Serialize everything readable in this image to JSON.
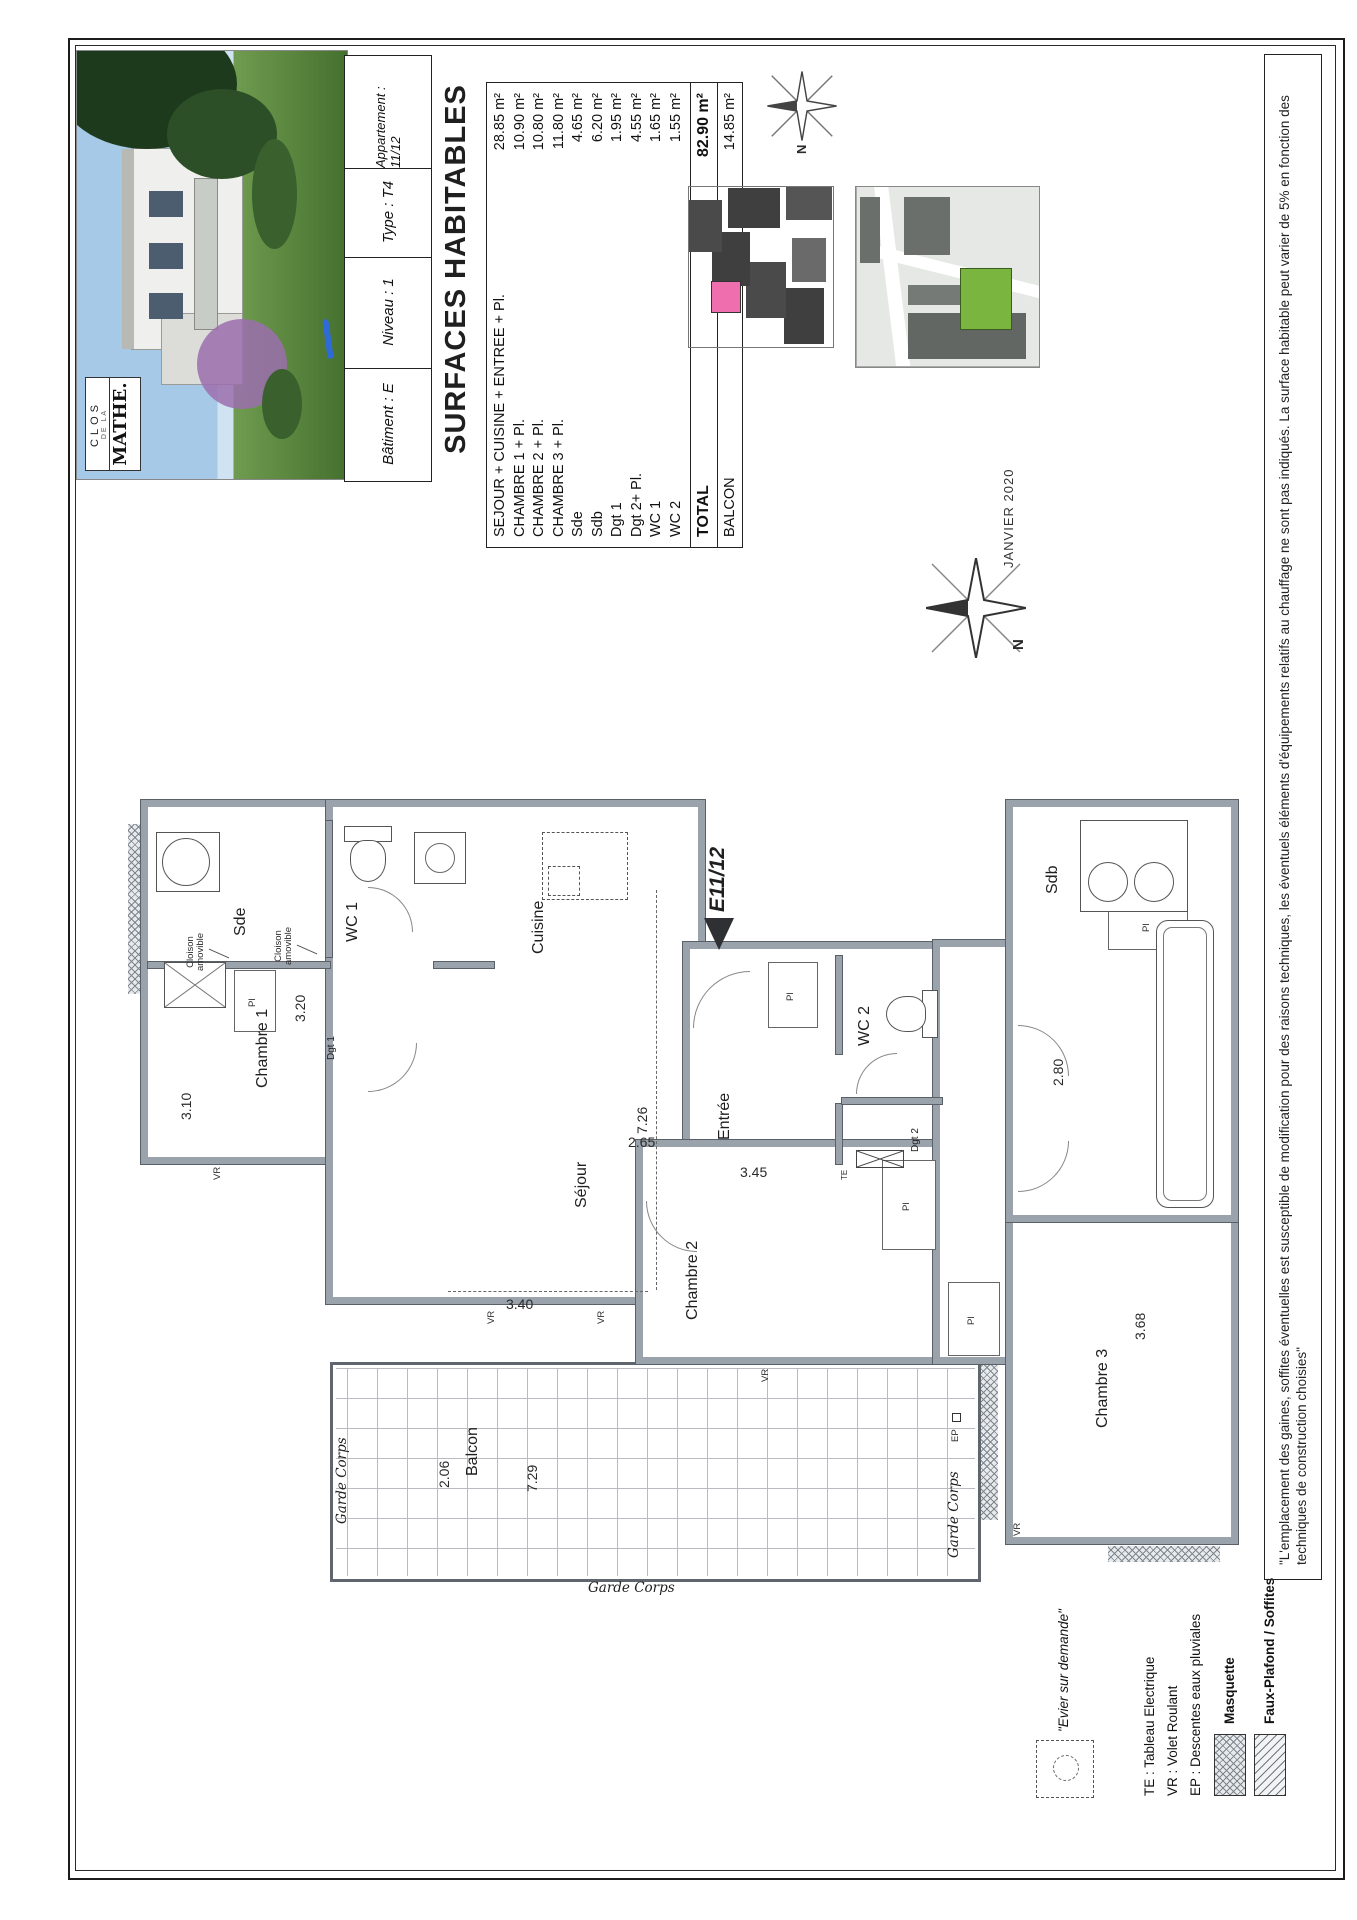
{
  "page": {
    "date": "JANVIER 2020",
    "watermark": "immobilier"
  },
  "logo": {
    "line1": "CLOS",
    "line2": "DE LA",
    "line3": "MATHE."
  },
  "title_block": {
    "batiment": "Bâtiment : E",
    "niveau": "Niveau : 1",
    "type": "Type : T4",
    "appartement": "Appartement : 11/12"
  },
  "surfaces": {
    "title": "SURFACES HABITABLES",
    "rows": [
      {
        "label": "SEJOUR + CUISINE + ENTREE + Pl.",
        "value": "28.85 m²"
      },
      {
        "label": "CHAMBRE 1 + Pl.",
        "value": "10.90 m²"
      },
      {
        "label": "CHAMBRE 2 + Pl.",
        "value": "10.80 m²"
      },
      {
        "label": "CHAMBRE 3 + Pl.",
        "value": "11.80 m²"
      },
      {
        "label": "Sde",
        "value": "4.65 m²"
      },
      {
        "label": "Sdb",
        "value": "6.20 m²"
      },
      {
        "label": "Dgt 1",
        "value": "1.95 m²"
      },
      {
        "label": "Dgt 2+ Pl.",
        "value": "4.55 m²"
      },
      {
        "label": "WC 1",
        "value": "1.65 m²"
      },
      {
        "label": "WC 2",
        "value": "1.55 m²"
      }
    ],
    "total_label": "TOTAL",
    "total_value": "82.90 m²",
    "balcon_label": "BALCON",
    "balcon_value": "14.85 m²"
  },
  "plan": {
    "unit_marker": "E11/12",
    "rooms": {
      "sde": "Sde",
      "wc1": "WC 1",
      "cuisine": "Cuisine",
      "sejour": "Séjour",
      "chambre1": "Chambre 1",
      "entree": "Entrée",
      "wc2": "WC 2",
      "sdb": "Sdb",
      "chambre2": "Chambre 2",
      "chambre3": "Chambre 3",
      "balcon": "Balcon",
      "dgt1": "Dgt 1",
      "dgt2": "Dgt 2"
    },
    "dims": {
      "d310": "3.10",
      "d320": "3.20",
      "d340": "3.40",
      "d726": "7.26",
      "d265": "2.65",
      "d345": "3.45",
      "d206": "2.06",
      "d729": "7.29",
      "d280": "2.80",
      "d368": "3.68"
    },
    "tags": {
      "vr": "VR",
      "ep": "EP",
      "te": "TE",
      "pl": "Pl"
    },
    "annotations": {
      "cloison": "Cloison amovible",
      "garde_corps": "Garde Corps"
    },
    "compass": "N"
  },
  "legend": {
    "evier": "\"Evier sur demande\"",
    "te": "TE : Tableau Electrique",
    "vr": "VR : Volet Roulant",
    "ep": "EP : Descentes eaux pluviales",
    "masquette": "Masquette",
    "faux_plafond": "Faux-Plafond / Soffites"
  },
  "disclaimer": "\"L'emplacement des gaines, soffites éventuelles est susceptible de modification pour des raisons techniques, les éventuels éléments d'équipements relatifs au chauffage ne sont pas indiqués. La surface habitable peut varier de 5% en fonction des techniques de construction choisies\"",
  "colors": {
    "highlight_unit": "#ef6fae",
    "highlight_building": "#79b53f",
    "wall": "#9aa2ab"
  }
}
